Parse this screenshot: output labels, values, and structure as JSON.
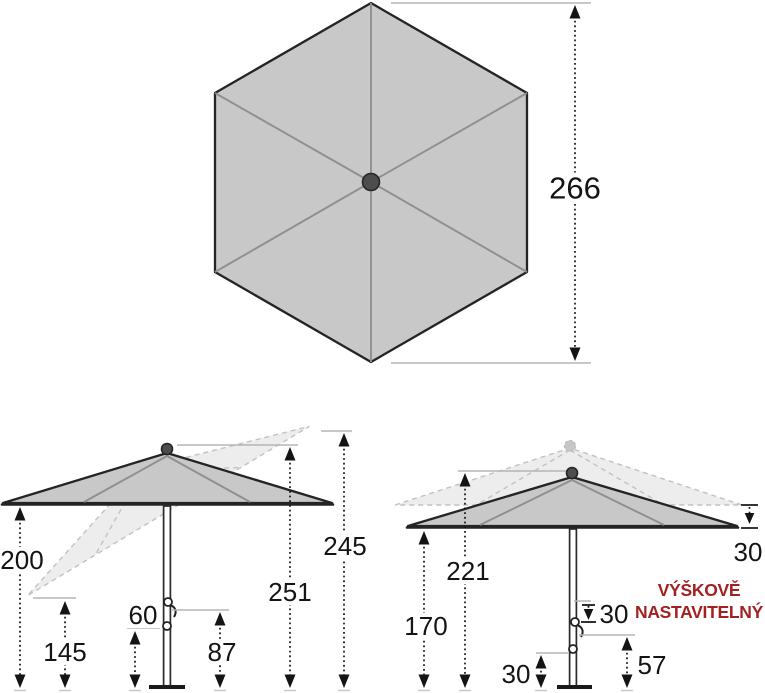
{
  "figure": {
    "type": "parasol-dimension-diagram",
    "subject": "hexagonal garden parasol with tilt and height adjustment",
    "canopy_color": "#c8c8c8",
    "line_color": "#141414",
    "accent_red": "#a22121"
  },
  "top_view": {
    "diameter": "266"
  },
  "left_parasol": {
    "edge_height": "200",
    "tilted_edge_height": "145",
    "lower_hub_height": "60",
    "upper_hub_height": "87",
    "pole_top_height": "251",
    "tilted_top_height": "245"
  },
  "right_parasol": {
    "edge_height": "170",
    "top_height": "221",
    "edge_lift": "30",
    "slider_travel": "30",
    "crank_height": "57",
    "lower_hub_height": "30",
    "note_line1": "VÝŠKOVĚ",
    "note_line2": "NASTAVITELNÝ"
  }
}
